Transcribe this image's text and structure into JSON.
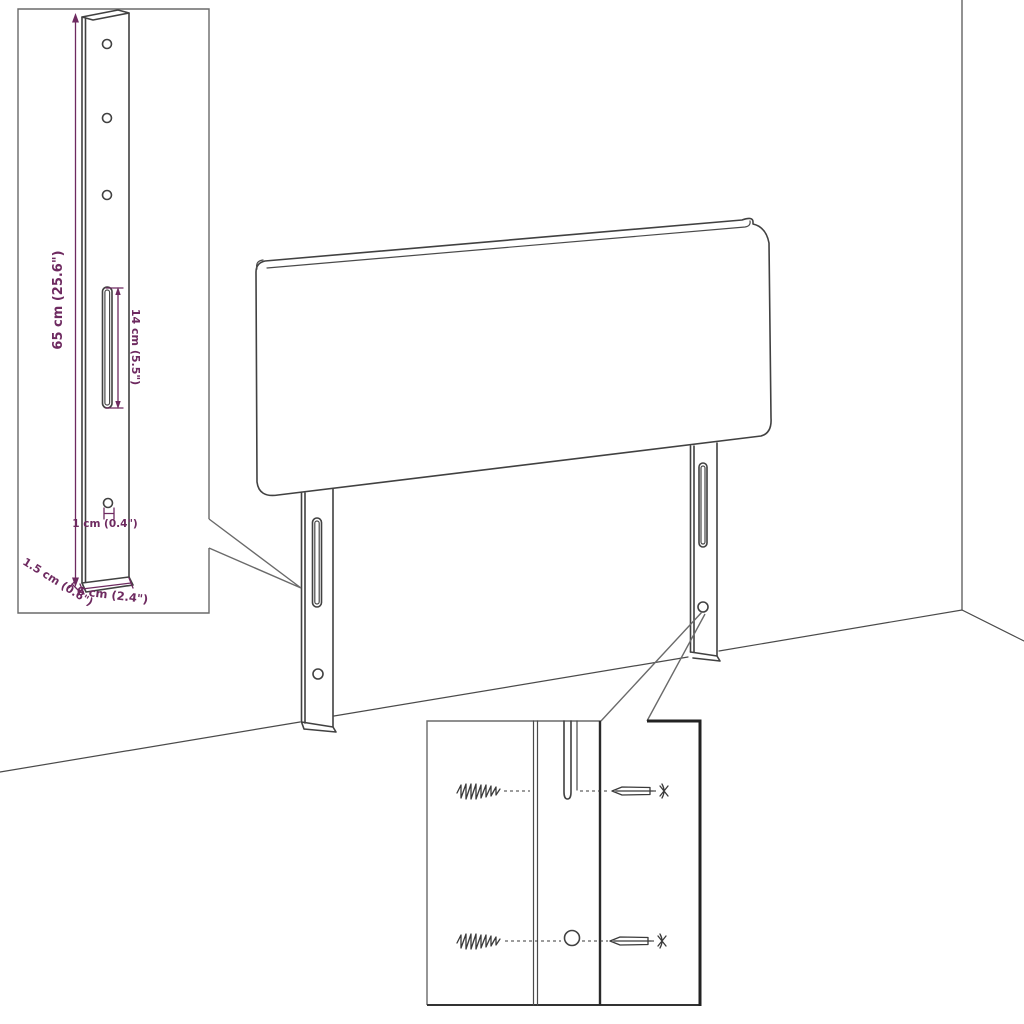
{
  "diagram": {
    "title": "headboard-assembly-dimension-diagram",
    "dimensions": {
      "height": "65 cm (25.6\")",
      "slot": "14 cm (5.5\")",
      "hole": "1 cm (0.4\")",
      "width": "6 cm (2.4\")",
      "depth": "1.5 cm (0.6\")"
    },
    "colors": {
      "dimension": "#6e2a60",
      "line": "#414141",
      "background": "#ffffff"
    }
  }
}
